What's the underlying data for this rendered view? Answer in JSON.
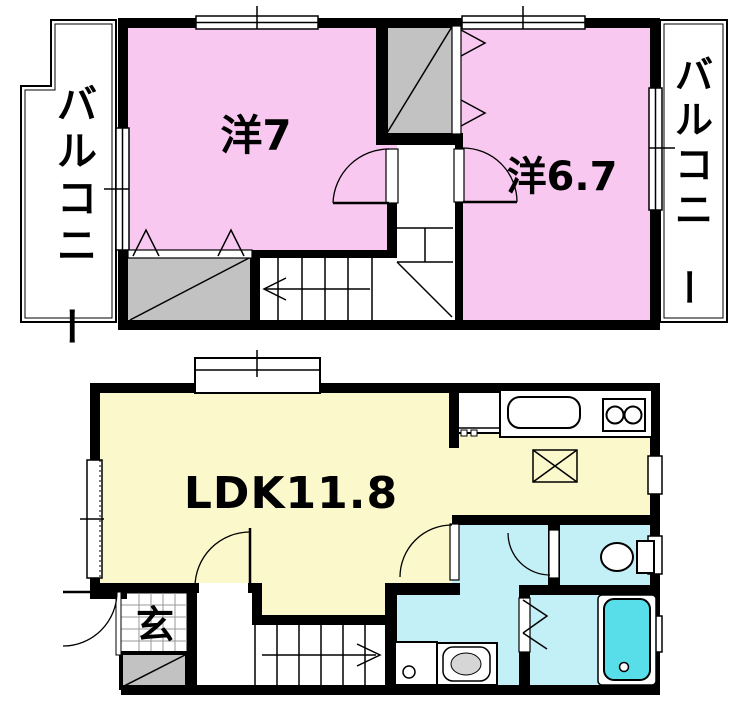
{
  "plan": {
    "type": "apartment-floor-plan",
    "floors": {
      "upper": {
        "rooms": [
          {
            "id": "bedroom1",
            "label": "洋7"
          },
          {
            "id": "bedroom2",
            "label": "洋6.7"
          }
        ],
        "balcony_left": "バルコニー",
        "balcony_right": "バルコニー",
        "features": [
          "closet",
          "closet",
          "staircase-down-arrow-left",
          "hall",
          "swing-doors"
        ]
      },
      "lower": {
        "rooms": [
          {
            "id": "ldk",
            "label": "LDK11.8"
          },
          {
            "id": "entrance",
            "label": "玄"
          }
        ],
        "features": [
          "bay-window",
          "kitchen-counter",
          "two-burner-stove",
          "kitchen-sink",
          "refrigerator-space-x-box",
          "washing-machine",
          "wash-basin",
          "toilet",
          "bathtub",
          "staircase-up-arrow-right",
          "shoe-cabinet",
          "entry-door"
        ]
      }
    },
    "colors": {
      "bedroom": "#F8C8F0",
      "ldk": "#FBF8CB",
      "wet_area": "#C3EFF6",
      "bathtub": "#58DEE9",
      "closet": "#C2C2C2",
      "basin": "#D6D6D6",
      "wall": "#000000"
    }
  }
}
